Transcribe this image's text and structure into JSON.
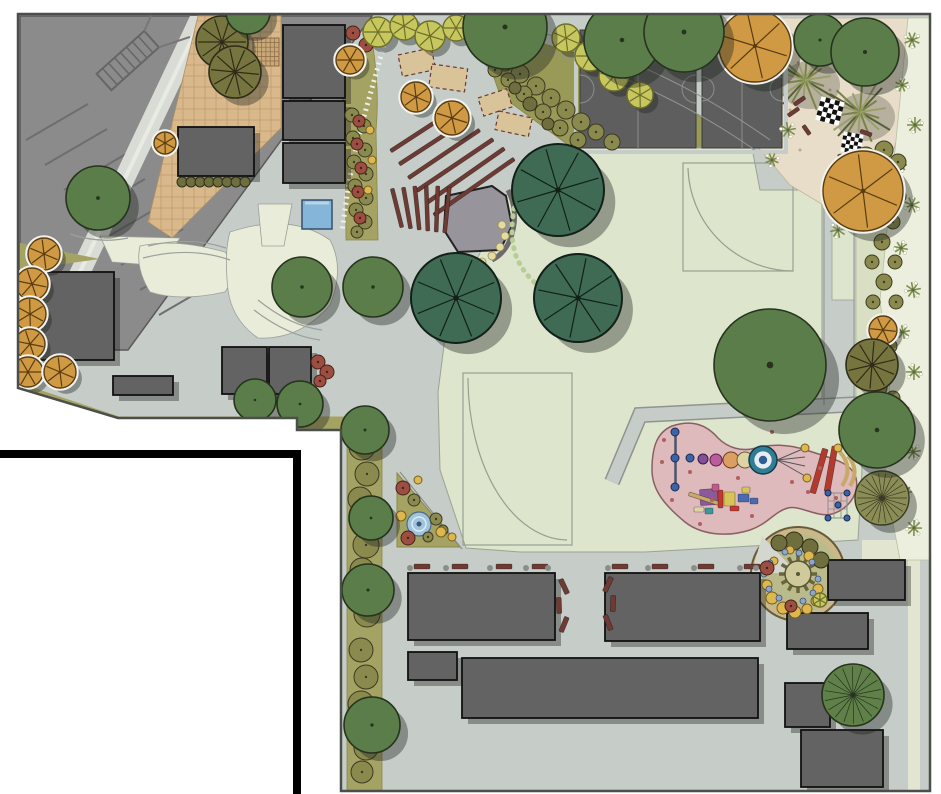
{
  "title": "park-master-plan",
  "palette": {
    "page_bg": "#ffffff",
    "plaza": "#c6cdc8",
    "plaza_edge": "#4a4f4a",
    "parking": "#8b8b8b",
    "parking_line": "#6e6e6e",
    "path_light": "#d9dcd5",
    "tan_plaza": "#d9b98c",
    "sand": "#e7ddc9",
    "lawn": "#dde5cd",
    "lawn_pale": "#e9ecd9",
    "olive_bed": "#a5a363",
    "bed_diag": "#9a9a58",
    "bed_right": "#d9dfc2",
    "palm_strip": "#ecefdd",
    "building": "#636363",
    "bench": "#6e3a34",
    "stage": "#98949b",
    "water_square": "#85b5d8",
    "fountain": "#9fc4dc",
    "playground_pink": "#debabd",
    "sensory_ring": "#c9b88a",
    "sensory_fill": "#b9bc8a",
    "tree_dark_green": "#3f6b54",
    "tree_med_green": "#5b7d4a",
    "tree_olive": "#77753f",
    "tree_orange": "#cf9a43",
    "shrub_olive": "#8a8a4f",
    "flower_rust": "#9b4f42",
    "flower_yellow": "#ddb84f",
    "shrub_yellowgreen": "#c6c75f",
    "palm_green": "#7d8d50",
    "boundary_black": "#000000"
  },
  "buildings": [
    [
      283,
      25,
      62,
      73
    ],
    [
      283,
      101,
      62,
      39
    ],
    [
      283,
      143,
      62,
      40
    ],
    [
      178,
      127,
      76,
      49
    ],
    [
      38,
      272,
      76,
      88
    ],
    [
      222,
      347,
      45,
      47
    ],
    [
      269,
      347,
      42,
      47
    ],
    [
      113,
      376,
      60,
      19
    ],
    [
      408,
      573,
      147,
      67
    ],
    [
      605,
      573,
      155,
      68
    ],
    [
      408,
      652,
      49,
      28
    ],
    [
      462,
      658,
      296,
      60
    ],
    [
      828,
      560,
      77,
      40
    ],
    [
      787,
      613,
      81,
      36
    ],
    [
      785,
      683,
      45,
      44
    ],
    [
      801,
      730,
      82,
      57
    ]
  ],
  "bars": [
    [
      385,
      130,
      70,
      4,
      -33,
      ""
    ],
    [
      393,
      141,
      78,
      4,
      -33,
      ""
    ],
    [
      401,
      152,
      86,
      4,
      -34,
      ""
    ],
    [
      409,
      163,
      92,
      4,
      -34,
      ""
    ],
    [
      417,
      174,
      96,
      4,
      -35,
      ""
    ],
    [
      425,
      185,
      98,
      4,
      -35,
      ""
    ],
    [
      395,
      188,
      4,
      40,
      -14,
      ""
    ],
    [
      405,
      187,
      4,
      42,
      -10,
      ""
    ],
    [
      415,
      186,
      4,
      44,
      -6,
      ""
    ],
    [
      425,
      186,
      4,
      45,
      -2,
      ""
    ],
    [
      435,
      186,
      4,
      46,
      2,
      ""
    ],
    [
      445,
      187,
      4,
      46,
      6,
      ""
    ],
    [
      414,
      564,
      16,
      5,
      0,
      ""
    ],
    [
      452,
      564,
      16,
      5,
      0,
      ""
    ],
    [
      496,
      564,
      16,
      5,
      0,
      ""
    ],
    [
      532,
      564,
      16,
      5,
      0,
      ""
    ],
    [
      612,
      564,
      16,
      5,
      0,
      ""
    ],
    [
      652,
      564,
      16,
      5,
      0,
      ""
    ],
    [
      698,
      564,
      16,
      5,
      0,
      ""
    ],
    [
      744,
      564,
      16,
      5,
      0,
      ""
    ],
    [
      556,
      584,
      16,
      5,
      65,
      ""
    ],
    [
      551,
      603,
      16,
      5,
      88,
      ""
    ],
    [
      556,
      622,
      16,
      5,
      112,
      ""
    ],
    [
      600,
      582,
      16,
      5,
      -65,
      ""
    ],
    [
      605,
      601,
      16,
      5,
      -88,
      ""
    ],
    [
      600,
      620,
      16,
      5,
      -112,
      ""
    ],
    [
      793,
      99,
      13,
      4,
      -35,
      ""
    ],
    [
      787,
      110,
      13,
      4,
      -35,
      ""
    ],
    [
      801,
      128,
      11,
      4,
      55,
      ""
    ],
    [
      860,
      131,
      12,
      4,
      20,
      ""
    ],
    [
      835,
      158,
      12,
      4,
      75,
      ""
    ],
    [
      816,
      448,
      6,
      46,
      16,
      "#b23a2e"
    ],
    [
      828,
      446,
      6,
      46,
      10,
      "#b23a2e"
    ],
    [
      700,
      489,
      18,
      16,
      -4,
      "#8a5a9a"
    ],
    [
      688,
      497,
      34,
      4,
      18,
      "#c9a96a"
    ],
    [
      718,
      490,
      5,
      18,
      0,
      "#c03a30"
    ],
    [
      724,
      492,
      11,
      14,
      0,
      "#d8c35a"
    ],
    [
      712,
      484,
      7,
      7,
      0,
      "#c05a8a"
    ],
    [
      738,
      494,
      11,
      8,
      0,
      "#4a6ab0"
    ],
    [
      705,
      508,
      8,
      6,
      0,
      "#3a9a9a"
    ],
    [
      730,
      506,
      9,
      5,
      0,
      "#c03a30"
    ],
    [
      742,
      487,
      8,
      6,
      0,
      "#d8c35a"
    ],
    [
      750,
      498,
      8,
      6,
      0,
      "#4a6ab0"
    ],
    [
      694,
      507,
      10,
      5,
      0,
      "#ddd3a3"
    ]
  ],
  "palms": [
    [
      912,
      40,
      8
    ],
    [
      902,
      85,
      7
    ],
    [
      915,
      125,
      8
    ],
    [
      900,
      165,
      7
    ],
    [
      912,
      205,
      8
    ],
    [
      901,
      248,
      7
    ],
    [
      913,
      290,
      8
    ],
    [
      903,
      332,
      7
    ],
    [
      914,
      372,
      8
    ],
    [
      904,
      412,
      7
    ],
    [
      913,
      452,
      8
    ],
    [
      905,
      492,
      7
    ],
    [
      914,
      528,
      8
    ],
    [
      788,
      130,
      8
    ],
    [
      772,
      160,
      7
    ],
    [
      838,
      230,
      8
    ]
  ],
  "plants": [
    [
      352,
      115,
      7,
      "o"
    ],
    [
      364,
      126,
      7,
      "o"
    ],
    [
      353,
      138,
      7,
      "o"
    ],
    [
      365,
      150,
      7,
      "o"
    ],
    [
      354,
      162,
      7,
      "o"
    ],
    [
      366,
      174,
      7,
      "o"
    ],
    [
      355,
      186,
      7,
      "o"
    ],
    [
      366,
      198,
      7,
      "o"
    ],
    [
      356,
      210,
      7,
      "o"
    ],
    [
      365,
      222,
      7,
      "o"
    ],
    [
      357,
      232,
      6,
      "o"
    ],
    [
      359,
      121,
      6,
      "rust"
    ],
    [
      357,
      144,
      6,
      "rust"
    ],
    [
      361,
      168,
      6,
      "rust"
    ],
    [
      358,
      192,
      6,
      "rust"
    ],
    [
      360,
      218,
      6,
      "rust"
    ],
    [
      353,
      33,
      7,
      "rust"
    ],
    [
      366,
      45,
      7,
      "rust"
    ],
    [
      356,
      54,
      6,
      "rust"
    ],
    [
      370,
      130,
      4,
      "y"
    ],
    [
      372,
      160,
      4,
      "y"
    ],
    [
      368,
      190,
      4,
      "y"
    ],
    [
      182,
      182,
      5,
      "od"
    ],
    [
      191,
      182,
      5,
      "od"
    ],
    [
      200,
      182,
      5,
      "od"
    ],
    [
      209,
      182,
      5,
      "od"
    ],
    [
      218,
      182,
      5,
      "od"
    ],
    [
      227,
      182,
      5,
      "od"
    ],
    [
      236,
      182,
      5,
      "od"
    ],
    [
      245,
      182,
      5,
      "od"
    ],
    [
      378,
      32,
      15,
      "ygt"
    ],
    [
      404,
      26,
      14,
      "ygt"
    ],
    [
      430,
      36,
      15,
      "ygt"
    ],
    [
      456,
      28,
      13,
      "ygt"
    ],
    [
      566,
      38,
      14,
      "ygt"
    ],
    [
      590,
      56,
      15,
      "ygt"
    ],
    [
      614,
      76,
      15,
      "ygt"
    ],
    [
      640,
      95,
      13,
      "ygt"
    ],
    [
      505,
      62,
      9,
      "o"
    ],
    [
      520,
      74,
      9,
      "o"
    ],
    [
      536,
      86,
      9,
      "o"
    ],
    [
      551,
      98,
      9,
      "o"
    ],
    [
      566,
      110,
      9,
      "o"
    ],
    [
      581,
      122,
      9,
      "o"
    ],
    [
      596,
      132,
      8,
      "o"
    ],
    [
      612,
      142,
      8,
      "o"
    ],
    [
      524,
      94,
      8,
      "o"
    ],
    [
      543,
      112,
      8,
      "o"
    ],
    [
      560,
      128,
      8,
      "o"
    ],
    [
      578,
      140,
      8,
      "o"
    ],
    [
      508,
      80,
      7,
      "o"
    ],
    [
      495,
      70,
      7,
      "o"
    ],
    [
      530,
      104,
      7,
      "od"
    ],
    [
      515,
      88,
      6,
      "od"
    ],
    [
      548,
      124,
      6,
      "od"
    ],
    [
      866,
      156,
      9,
      "o"
    ],
    [
      884,
      150,
      9,
      "o"
    ],
    [
      898,
      162,
      8,
      "o"
    ],
    [
      870,
      174,
      8,
      "o"
    ],
    [
      888,
      180,
      8,
      "o"
    ],
    [
      899,
      196,
      7,
      "o"
    ],
    [
      867,
      192,
      7,
      "o"
    ],
    [
      880,
      206,
      8,
      "o"
    ],
    [
      893,
      222,
      7,
      "o"
    ],
    [
      869,
      224,
      7,
      "o"
    ],
    [
      882,
      242,
      8,
      "o"
    ],
    [
      895,
      262,
      7,
      "o"
    ],
    [
      872,
      262,
      7,
      "o"
    ],
    [
      884,
      282,
      8,
      "o"
    ],
    [
      896,
      302,
      7,
      "o"
    ],
    [
      873,
      302,
      7,
      "o"
    ],
    [
      886,
      322,
      7,
      "o"
    ],
    [
      890,
      346,
      7,
      "o"
    ],
    [
      880,
      388,
      7,
      "o"
    ],
    [
      893,
      398,
      7,
      "o"
    ],
    [
      362,
      447,
      13,
      "o"
    ],
    [
      367,
      474,
      12,
      "o"
    ],
    [
      360,
      499,
      12,
      "o"
    ],
    [
      366,
      545,
      13,
      "o"
    ],
    [
      362,
      570,
      12,
      "o"
    ],
    [
      367,
      614,
      13,
      "o"
    ],
    [
      361,
      650,
      12,
      "o"
    ],
    [
      366,
      677,
      12,
      "o"
    ],
    [
      361,
      704,
      13,
      "o"
    ],
    [
      366,
      748,
      12,
      "o"
    ],
    [
      362,
      772,
      11,
      "o"
    ],
    [
      414,
      500,
      6,
      "o"
    ],
    [
      436,
      519,
      6,
      "o"
    ],
    [
      428,
      537,
      5,
      "o"
    ],
    [
      443,
      530,
      5,
      "o"
    ],
    [
      403,
      488,
      7,
      "rust"
    ],
    [
      408,
      538,
      7,
      "rust"
    ],
    [
      401,
      516,
      5,
      "y"
    ],
    [
      441,
      532,
      5,
      "y"
    ],
    [
      452,
      537,
      4,
      "y"
    ],
    [
      418,
      480,
      4,
      "y"
    ],
    [
      318,
      362,
      7,
      "rust"
    ],
    [
      327,
      372,
      7,
      "rust"
    ],
    [
      320,
      381,
      6,
      "rust"
    ],
    [
      794,
      541,
      9,
      "od"
    ],
    [
      810,
      547,
      8,
      "od"
    ],
    [
      779,
      543,
      8,
      "od"
    ],
    [
      821,
      560,
      8,
      "od"
    ],
    [
      772,
      598,
      6,
      "y"
    ],
    [
      783,
      608,
      6,
      "y"
    ],
    [
      795,
      612,
      6,
      "y"
    ],
    [
      807,
      609,
      5,
      "y"
    ],
    [
      816,
      601,
      5,
      "y"
    ],
    [
      767,
      585,
      5,
      "y"
    ],
    [
      818,
      589,
      5,
      "y"
    ],
    [
      809,
      556,
      5,
      "y"
    ],
    [
      790,
      550,
      4,
      "y"
    ],
    [
      774,
      561,
      4,
      "y"
    ],
    [
      764,
      574,
      3,
      "blue"
    ],
    [
      769,
      589,
      3,
      "blue"
    ],
    [
      779,
      598,
      3,
      "blue"
    ],
    [
      791,
      603,
      3,
      "blue"
    ],
    [
      803,
      601,
      3,
      "blue"
    ],
    [
      813,
      593,
      3,
      "blue"
    ],
    [
      818,
      579,
      3,
      "blue"
    ],
    [
      812,
      562,
      3,
      "blue"
    ],
    [
      799,
      553,
      3,
      "blue"
    ],
    [
      785,
      552,
      3,
      "blue"
    ],
    [
      770,
      563,
      3,
      "blue"
    ],
    [
      767,
      568,
      7,
      "rust"
    ],
    [
      791,
      606,
      6,
      "rust"
    ],
    [
      820,
      600,
      7,
      "ygt"
    ],
    [
      410,
      568,
      3,
      "gd"
    ],
    [
      446,
      568,
      3,
      "gd"
    ],
    [
      490,
      568,
      3,
      "gd"
    ],
    [
      526,
      568,
      3,
      "gd"
    ],
    [
      548,
      568,
      3,
      "gd"
    ],
    [
      608,
      568,
      3,
      "gd"
    ],
    [
      648,
      568,
      3,
      "gd"
    ],
    [
      694,
      568,
      3,
      "gd"
    ],
    [
      740,
      568,
      3,
      "gd"
    ],
    [
      756,
      568,
      3,
      "gd"
    ],
    [
      662,
      462,
      2,
      "pspeck"
    ],
    [
      672,
      500,
      2,
      "pspeck"
    ],
    [
      690,
      472,
      2,
      "pspeck"
    ],
    [
      712,
      500,
      2,
      "pspeck"
    ],
    [
      738,
      478,
      2,
      "pspeck"
    ],
    [
      752,
      516,
      2,
      "pspeck"
    ],
    [
      700,
      524,
      2,
      "pspeck"
    ],
    [
      792,
      482,
      2,
      "pspeck"
    ],
    [
      820,
      468,
      2,
      "pspeck"
    ],
    [
      836,
      498,
      2,
      "pspeck"
    ],
    [
      664,
      440,
      2,
      "pspeck"
    ],
    [
      772,
      432,
      2,
      "pspeck"
    ],
    [
      808,
      492,
      2,
      "pspeck"
    ],
    [
      758,
      468,
      2,
      "pspeck"
    ],
    [
      675,
      432,
      4,
      "pblue"
    ],
    [
      675,
      458,
      4,
      "pblue"
    ],
    [
      675,
      487,
      4,
      "pblue"
    ],
    [
      690,
      458,
      4,
      "pblue"
    ],
    [
      703,
      459,
      5,
      "ppurple"
    ],
    [
      716,
      460,
      6,
      "pmag"
    ],
    [
      731,
      460,
      8,
      "porange"
    ],
    [
      745,
      460,
      8,
      "pcream"
    ],
    [
      763,
      460,
      14,
      "pring"
    ],
    [
      805,
      448,
      4,
      "y"
    ],
    [
      807,
      478,
      4,
      "y"
    ],
    [
      838,
      448,
      4,
      "y"
    ],
    [
      828,
      493,
      3,
      "pblue"
    ],
    [
      847,
      493,
      3,
      "pblue"
    ],
    [
      828,
      518,
      3,
      "pblue"
    ],
    [
      847,
      518,
      3,
      "pblue"
    ],
    [
      838,
      505,
      3,
      "pblue"
    ],
    [
      44,
      254,
      16,
      "org"
    ],
    [
      32,
      284,
      16,
      "org"
    ],
    [
      30,
      314,
      16,
      "org"
    ],
    [
      30,
      344,
      15,
      "org"
    ],
    [
      28,
      372,
      15,
      "org"
    ],
    [
      60,
      372,
      16,
      "org"
    ],
    [
      165,
      143,
      11,
      "org"
    ],
    [
      350,
      60,
      14,
      "org"
    ],
    [
      416,
      97,
      15,
      "org"
    ],
    [
      452,
      118,
      17,
      "org"
    ],
    [
      755,
      46,
      36,
      "org"
    ],
    [
      863,
      191,
      40,
      "org"
    ],
    [
      883,
      330,
      14,
      "org"
    ],
    [
      222,
      42,
      26,
      "op"
    ],
    [
      235,
      72,
      26,
      "op"
    ],
    [
      872,
      365,
      26,
      "op"
    ],
    [
      882,
      498,
      27,
      "or"
    ],
    [
      853,
      695,
      31,
      "gr"
    ],
    [
      248,
      12,
      22,
      "g"
    ],
    [
      505,
      27,
      42,
      "g"
    ],
    [
      622,
      40,
      38,
      "g"
    ],
    [
      684,
      32,
      40,
      "g"
    ],
    [
      820,
      40,
      26,
      "g"
    ],
    [
      865,
      52,
      34,
      "g"
    ],
    [
      98,
      198,
      32,
      "g"
    ],
    [
      302,
      287,
      30,
      "g"
    ],
    [
      373,
      287,
      30,
      "g"
    ],
    [
      255,
      400,
      21,
      "g"
    ],
    [
      300,
      404,
      23,
      "g"
    ],
    [
      365,
      430,
      24,
      "g"
    ],
    [
      371,
      518,
      22,
      "g"
    ],
    [
      368,
      590,
      26,
      "g"
    ],
    [
      372,
      725,
      28,
      "g"
    ],
    [
      770,
      365,
      56,
      "g"
    ],
    [
      877,
      430,
      38,
      "g"
    ],
    [
      558,
      190,
      46,
      "pd"
    ],
    [
      456,
      298,
      45,
      "pd"
    ],
    [
      578,
      298,
      44,
      "pd"
    ]
  ]
}
